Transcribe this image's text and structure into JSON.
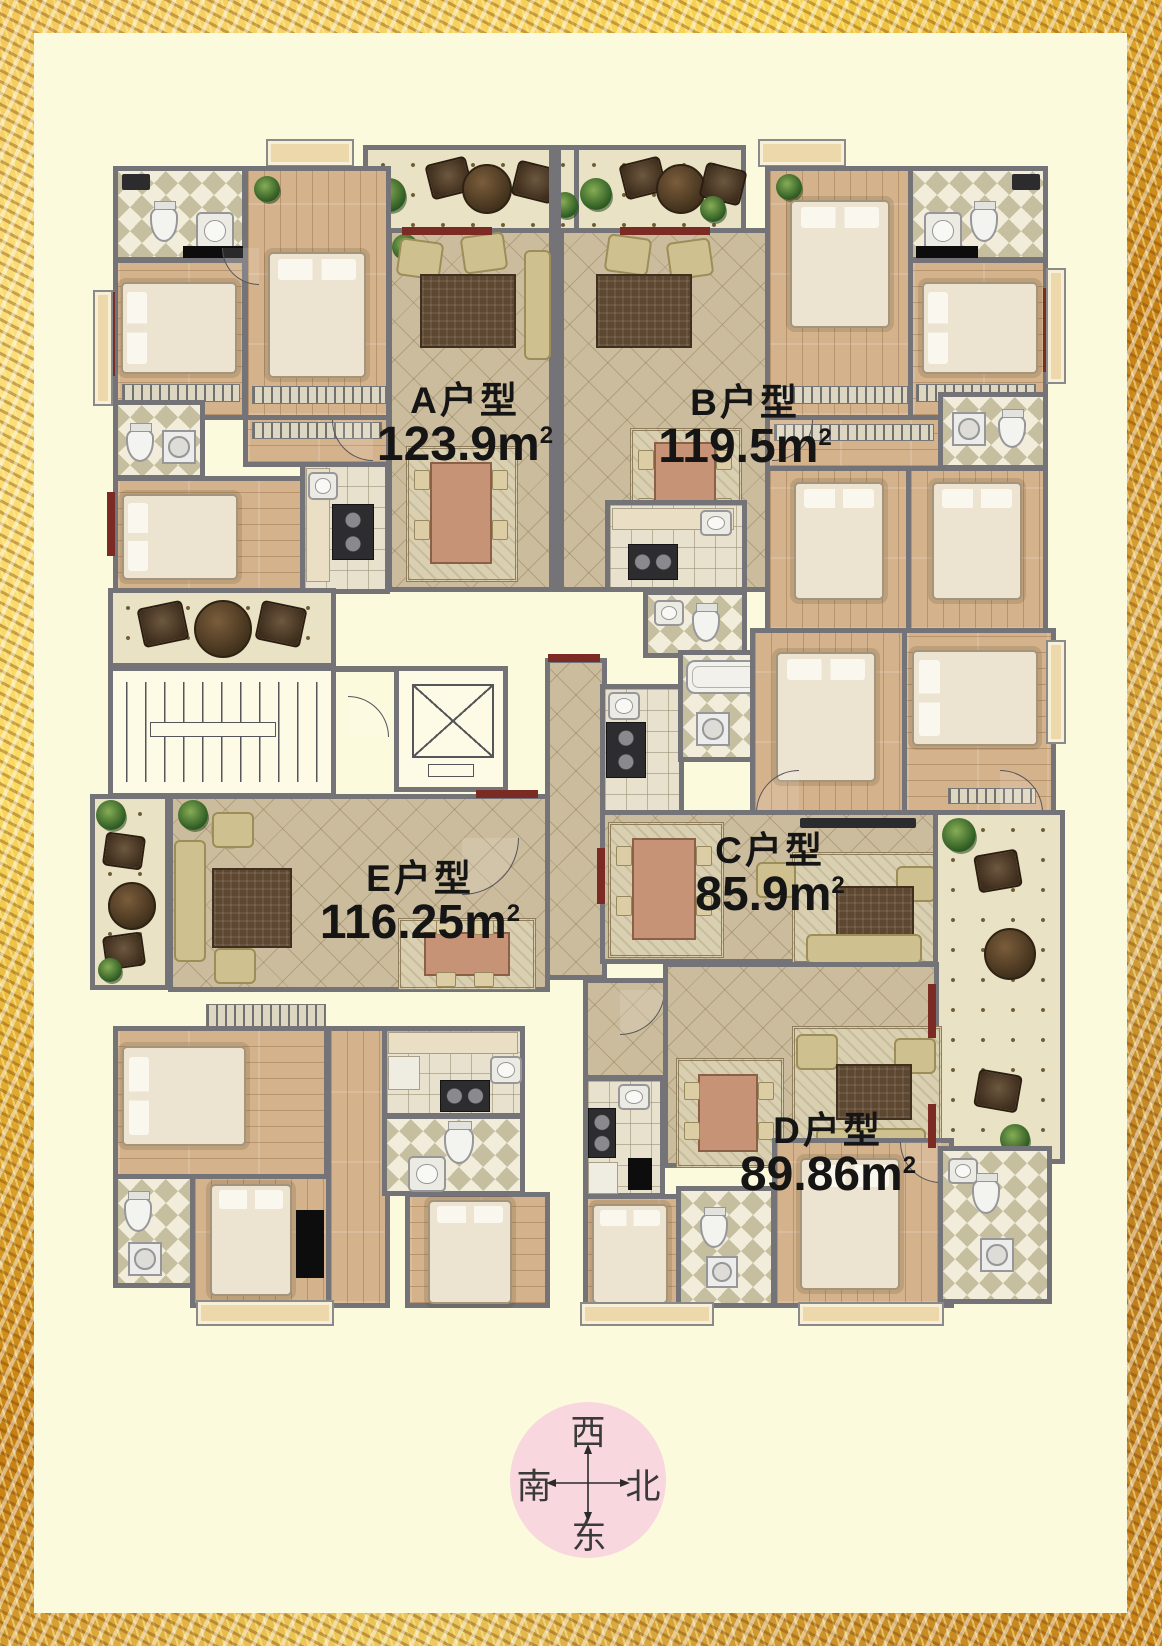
{
  "poster": {
    "type": "residential-floor-plan"
  },
  "units": [
    {
      "id": "A",
      "name": "A户型",
      "area": "123.9m",
      "area_sup": "2"
    },
    {
      "id": "B",
      "name": "B户型",
      "area": "119.5m",
      "area_sup": "2"
    },
    {
      "id": "C",
      "name": "C户型",
      "area": "85.9m",
      "area_sup": "2"
    },
    {
      "id": "D",
      "name": "D户型",
      "area": "89.86m",
      "area_sup": "2"
    },
    {
      "id": "E",
      "name": "E户型",
      "area": "116.25m",
      "area_sup": "2"
    }
  ],
  "compass": {
    "top": "西",
    "left": "南",
    "right": "北",
    "bottom": "东"
  },
  "colors": {
    "frame_gold": "#E8B132",
    "paper": "#FCFADD",
    "wall_gray": "#737378",
    "window_maroon": "#7C2B24",
    "tile_tan": "#CBBC9D",
    "wood": "#D4B28C",
    "label_text": "#151515",
    "compass_pink": "#F8D7DE"
  }
}
